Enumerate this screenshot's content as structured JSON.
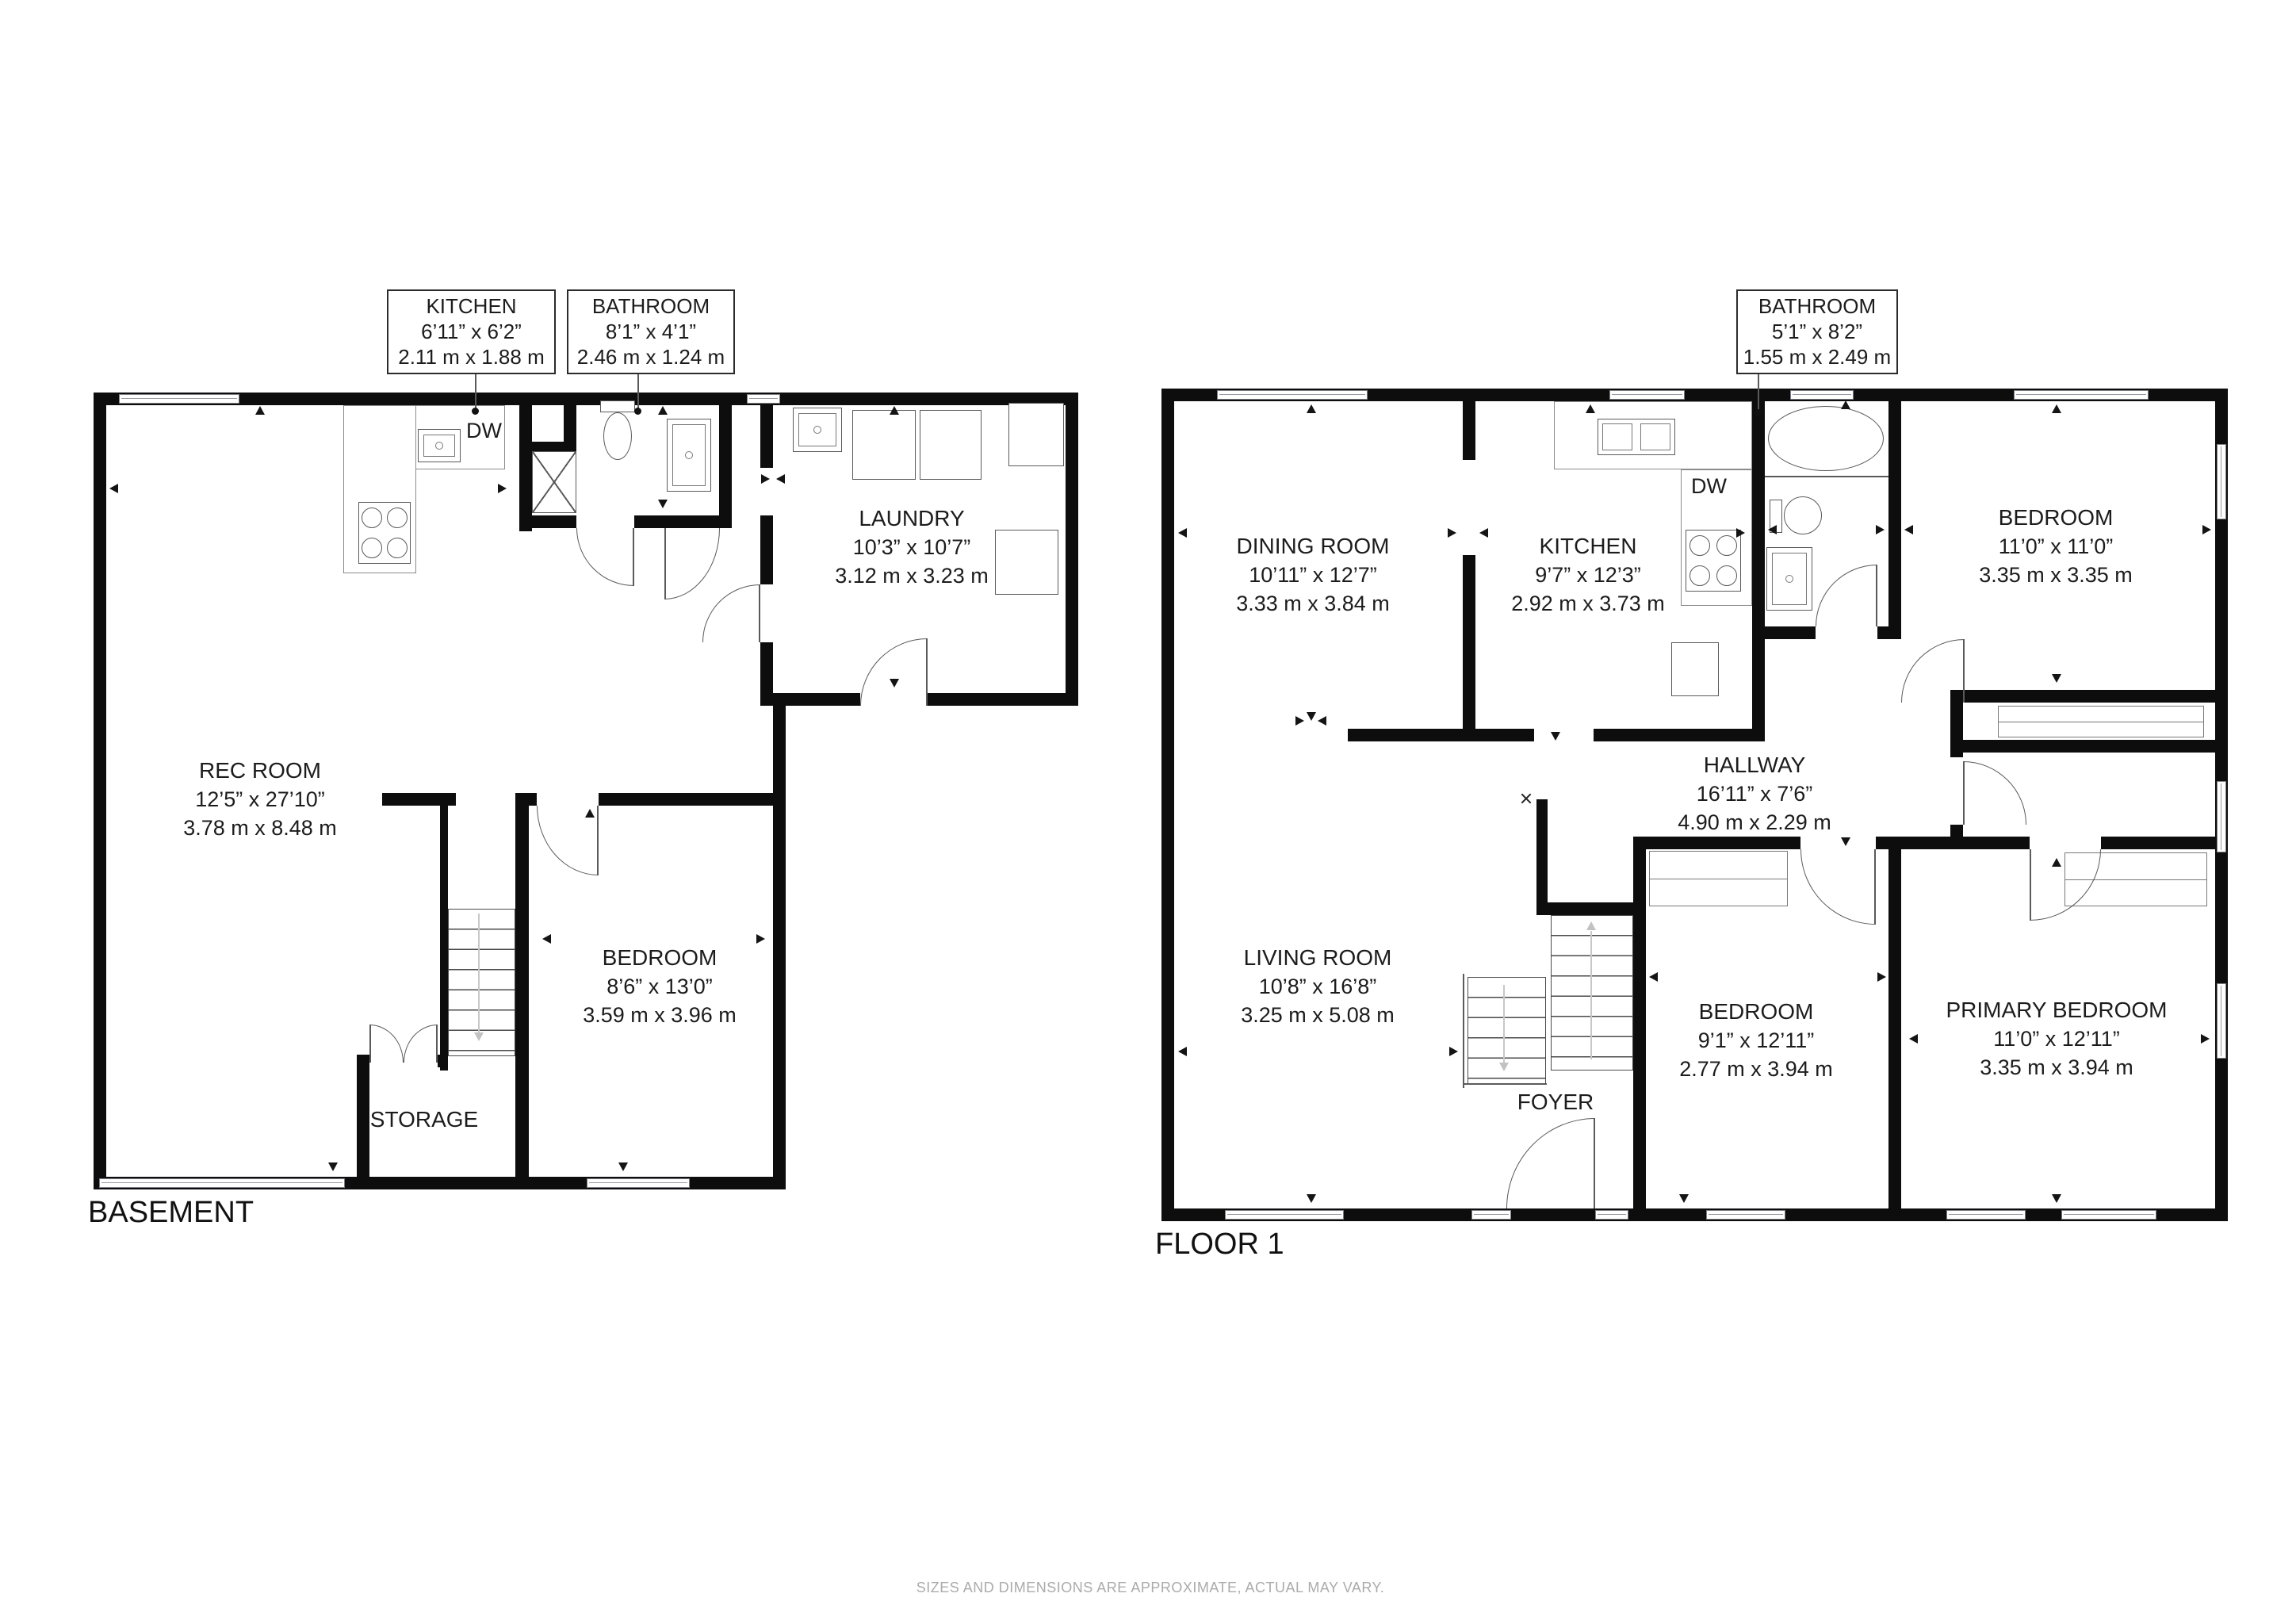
{
  "footer": {
    "disclaimer": "SIZES AND DIMENSIONS ARE APPROXIMATE, ACTUAL MAY VARY."
  },
  "basement": {
    "title": "BASEMENT",
    "dw_label": "DW",
    "callouts": [
      {
        "name": "KITCHEN",
        "imperial": "6’11” x 6’2”",
        "metric": "2.11 m x 1.88 m"
      },
      {
        "name": "BATHROOM",
        "imperial": "8’1” x 4’1”",
        "metric": "2.46 m x 1.24 m"
      }
    ],
    "rooms": [
      {
        "name": "LAUNDRY",
        "imperial": "10’3” x 10’7”",
        "metric": "3.12 m x 3.23 m"
      },
      {
        "name": "REC  ROOM",
        "imperial": "12’5” x 27’10”",
        "metric": "3.78 m x 8.48 m"
      },
      {
        "name": "BEDROOM",
        "imperial": "8’6” x 13’0”",
        "metric": "3.59 m x 3.96 m"
      },
      {
        "name": "STORAGE"
      }
    ]
  },
  "floor1": {
    "title": "FLOOR 1",
    "dw_label": "DW",
    "callouts": [
      {
        "name": "BATHROOM",
        "imperial": "5’1” x 8’2”",
        "metric": "1.55 m x 2.49 m"
      }
    ],
    "rooms": [
      {
        "name": "DINING ROOM",
        "imperial": "10’11” x 12’7”",
        "metric": "3.33 m x 3.84 m"
      },
      {
        "name": "KITCHEN",
        "imperial": "9’7” x 12’3”",
        "metric": "2.92 m x 3.73 m"
      },
      {
        "name": "BEDROOM",
        "imperial": "11’0” x 11’0”",
        "metric": "3.35 m x 3.35 m"
      },
      {
        "name": "HALLWAY",
        "imperial": "16’11” x 7’6”",
        "metric": "4.90 m x 2.29 m"
      },
      {
        "name": "LIVING ROOM",
        "imperial": "10’8” x 16’8”",
        "metric": "3.25 m x 5.08 m"
      },
      {
        "name": "BEDROOM",
        "imperial": "9’1” x 12’11”",
        "metric": "2.77 m x 3.94 m"
      },
      {
        "name": "PRIMARY BEDROOM",
        "imperial": "11’0” x 12’11”",
        "metric": "3.35 m x 3.94 m"
      },
      {
        "name": "FOYER"
      }
    ]
  }
}
